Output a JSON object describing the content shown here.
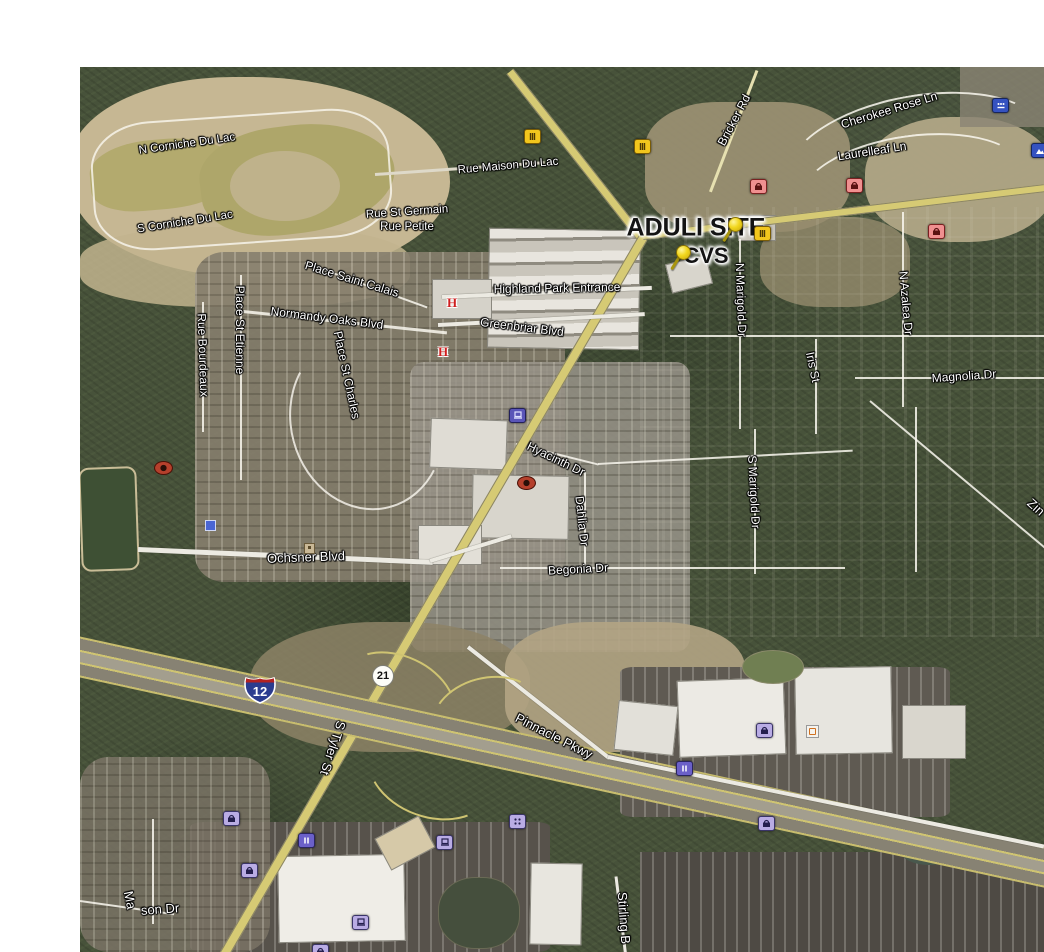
{
  "app": {
    "name": "satellite-map-view"
  },
  "site": {
    "aduli": "ADULI SITE",
    "cvs": "CVS"
  },
  "shields": {
    "interstate_12": "12",
    "route_21": "21"
  },
  "roads": {
    "n_corniche_du_lac": "N Corniche Du Lac",
    "s_corniche_du_lac": "S Corniche Du Lac",
    "rue_st_germain": "Rue St Germain",
    "rue_petite": "Rue Petite",
    "rue_maison_du_lac": "Rue Maison Du Lac",
    "place_saint_calais": "Place Saint Calais",
    "normandy_oaks_blvd": "Normandy Oaks Blvd",
    "place_st_etienne": "Place St Etienne",
    "rue_bourdeaux": "Rue Bourdeaux",
    "place_st_charles": "Place St Charles",
    "highland_park_entrance": "Highland Park Entrance",
    "greenbriar_blvd": "Greenbriar Blvd",
    "bricker_rd": "Bricker Rd",
    "cherokee_rose_ln": "Cherokee Rose Ln",
    "laurelleaf_ln": "Laurelleaf Ln",
    "n_marigold_dr": "N Marigold Dr",
    "n_azalea_dr": "N Azalea Dr",
    "iris_st": "Iris St",
    "magnolia_dr": "Magnolia Dr",
    "hyacinth_dr": "Hyacinth Dr",
    "dahlia_dr": "Dahlia Dr",
    "s_marigold_dr": "S Marigold Dr",
    "begonia_dr": "Begonia Dr",
    "ochsner_blvd": "Ochsner Blvd",
    "s_tyler_st": "S Tyler St",
    "pinnacle_pkwy": "Pinnacle Pkwy",
    "stirling_blvd_partial": "Stirling B",
    "mason_dr_part1": "Ma",
    "mason_dr_part2": "son Dr",
    "zinnia_partial": "Zin"
  },
  "icons": {
    "hospital_glyph": "H",
    "names": [
      "pushpin-icon",
      "restaurant-icon",
      "shopping-bag-icon-pink",
      "shopping-bag-icon-lavender",
      "gas-pump-icon",
      "storefront-dots-icon",
      "computer-icon",
      "bank-icon",
      "photo-icon",
      "hospital-icon",
      "webcam-icon",
      "marker-square-tan",
      "marker-square-blue",
      "marker-square-white"
    ]
  },
  "colors": {
    "highway_yellow": "#d6ca74",
    "minor_road": "#eceae2",
    "water_olive": "#aea66a",
    "forest_green": "#47523a",
    "pushpin": "#f2d71e",
    "poi_pink": "#ef9090",
    "poi_lavender": "#b9ace4",
    "poi_blue": "#3552c0",
    "interstate_blue": "#2b3c8f",
    "interstate_red": "#b22222"
  }
}
